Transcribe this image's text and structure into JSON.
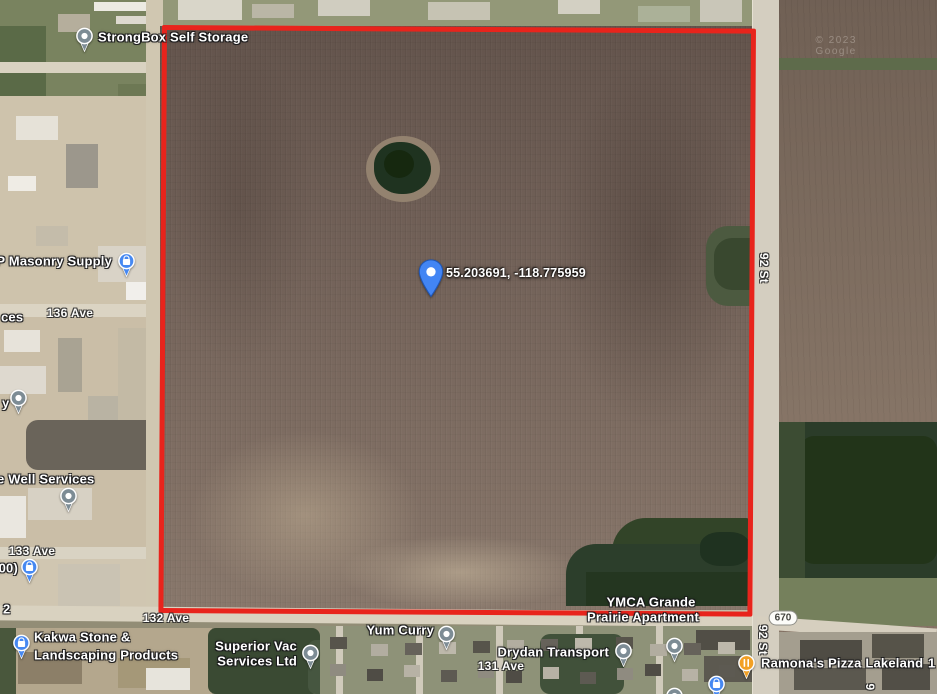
{
  "map": {
    "view": "satellite",
    "parcel_outline_color": "#e8241c",
    "marker": {
      "coordinates": "55.203691, -118.775959",
      "x": 431,
      "y": 298,
      "label_x": 446,
      "label_y": 273,
      "color": "#4285f4"
    },
    "pin_colors": {
      "generic": "#7d8c95",
      "shopping": "#4688f1",
      "restaurant": "#f2a024"
    },
    "highway_shield": {
      "text": "670",
      "x": 783,
      "y": 618
    },
    "watermark": {
      "text": "© 2023 Google",
      "x": 856,
      "y": 46
    },
    "pois": [
      {
        "id": "strongbox-self-storage",
        "pin": "generic",
        "px": 84,
        "py": 52,
        "lines": [
          {
            "text": "StrongBox Self Storage",
            "x": 98,
            "y": 37,
            "align": "left"
          }
        ]
      },
      {
        "id": "masonry-supply",
        "pin": "shopping",
        "px": 126,
        "py": 277,
        "lines": [
          {
            "text": "P Masonry Supply",
            "x": 112,
            "y": 261,
            "align": "right"
          }
        ]
      },
      {
        "id": "partial-label-ces",
        "pin": null,
        "lines": [
          {
            "text": "ces",
            "x": 1,
            "y": 317,
            "align": "left"
          }
        ]
      },
      {
        "id": "partial-label-y",
        "pin": "generic",
        "px": 18,
        "py": 414,
        "lines": [
          {
            "text": "y",
            "x": 2,
            "y": 403,
            "align": "left"
          }
        ]
      },
      {
        "id": "well-services",
        "pin": "generic",
        "px": 68,
        "py": 512,
        "lines": [
          {
            "text": "e Well Services",
            "x": -3,
            "y": 479,
            "align": "left"
          }
        ]
      },
      {
        "id": "partial-label-00",
        "pin": "shopping",
        "px": 29,
        "py": 583,
        "lines": [
          {
            "text": "(00)",
            "x": 18,
            "y": 568,
            "align": "right"
          }
        ]
      },
      {
        "id": "partial-label-2",
        "pin": null,
        "lines": [
          {
            "text": "2",
            "x": 3,
            "y": 609,
            "align": "left"
          }
        ]
      },
      {
        "id": "kakwa-stone-landscaping",
        "pin": "shopping",
        "px": 21,
        "py": 659,
        "lines": [
          {
            "text": "Kakwa Stone &",
            "x": 34,
            "y": 637,
            "align": "left"
          },
          {
            "text": "Landscaping Products",
            "x": 34,
            "y": 655,
            "align": "left"
          }
        ]
      },
      {
        "id": "superior-vac-services",
        "pin": "generic",
        "px": 310,
        "py": 669,
        "lines": [
          {
            "text": "Superior Vac",
            "x": 297,
            "y": 646,
            "align": "right"
          },
          {
            "text": "Services Ltd",
            "x": 297,
            "y": 661,
            "align": "right"
          }
        ]
      },
      {
        "id": "yum-curry",
        "pin": "generic",
        "px": 446,
        "py": 650,
        "lines": [
          {
            "text": "Yum Curry",
            "x": 434,
            "y": 630,
            "align": "right"
          }
        ]
      },
      {
        "id": "drydan-transport",
        "pin": "generic",
        "px": 623,
        "py": 667,
        "lines": [
          {
            "text": "Drydan Transport",
            "x": 609,
            "y": 652,
            "align": "right"
          }
        ]
      },
      {
        "id": "ymca-grande-prairie-apartment",
        "pin": "generic",
        "px": 674,
        "py": 662,
        "lines": [
          {
            "text": "YMCA Grande",
            "x": 651,
            "y": 602,
            "align": "center"
          },
          {
            "text": "Prairie Apartment",
            "x": 643,
            "y": 617,
            "align": "center"
          }
        ]
      },
      {
        "id": "ramonas-pizza-lakeland",
        "pin": "restaurant",
        "px": 746,
        "py": 679,
        "lines": [
          {
            "text": "Ramona's Pizza Lakeland",
            "x": 761,
            "y": 663,
            "align": "left"
          }
        ]
      },
      {
        "id": "partial-label-1",
        "pin": null,
        "lines": [
          {
            "text": "1",
            "x": 928,
            "y": 663,
            "align": "left"
          }
        ]
      },
      {
        "id": "blue-poi-bottom",
        "pin": "shopping",
        "px": 716,
        "py": 700,
        "lines": []
      },
      {
        "id": "partial-pin-bottom",
        "pin": "generic",
        "px": 674,
        "py": 712,
        "lines": []
      }
    ],
    "street_labels": [
      {
        "text": "136 Ave",
        "x": 70,
        "y": 313,
        "vertical": false
      },
      {
        "text": "133 Ave",
        "x": 32,
        "y": 551,
        "vertical": false
      },
      {
        "text": "132 Ave",
        "x": 166,
        "y": 618,
        "vertical": false
      },
      {
        "text": "131 Ave",
        "x": 501,
        "y": 666,
        "vertical": false
      },
      {
        "text": "92 St",
        "x": 764,
        "y": 268,
        "vertical": true
      },
      {
        "text": "92 St",
        "x": 763,
        "y": 640,
        "vertical": true
      },
      {
        "text": "9",
        "x": 870,
        "y": 687,
        "vertical": true
      }
    ]
  }
}
